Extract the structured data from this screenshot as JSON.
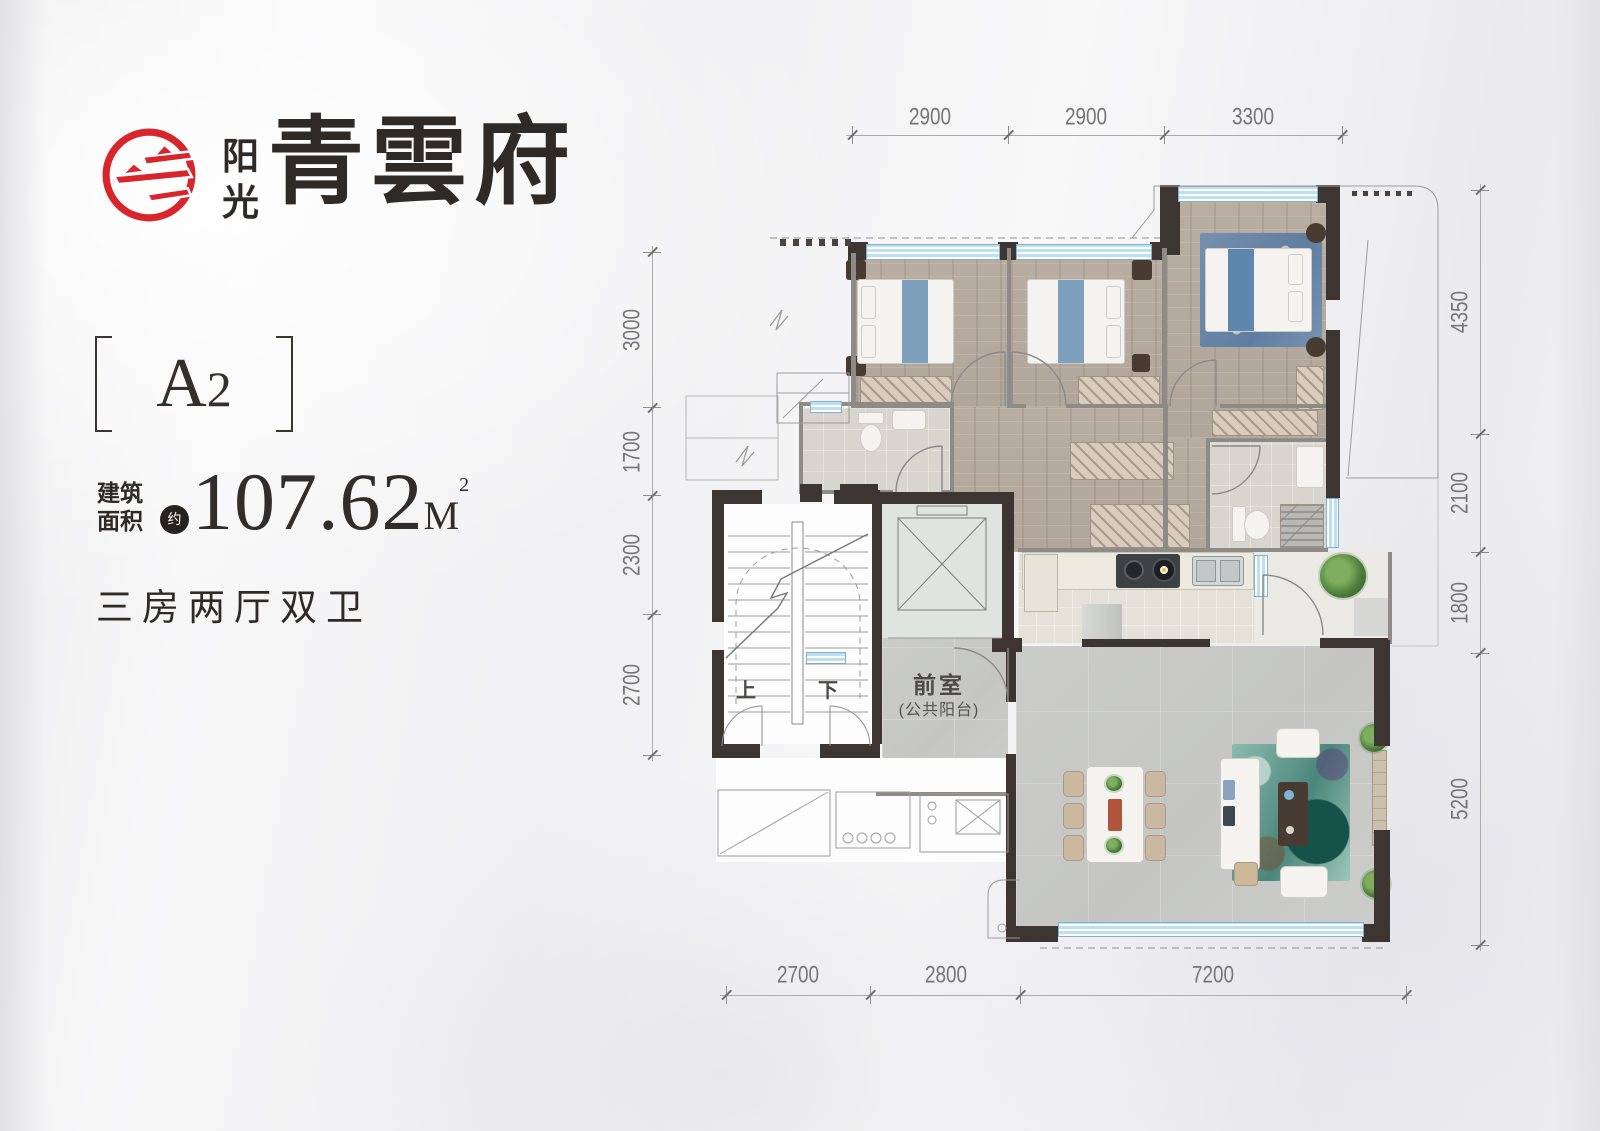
{
  "brand": {
    "logo_icon": "sun-swoosh-ring-icon",
    "name_small_top": "阳",
    "name_small_bottom": "光",
    "name_large": "青雲府"
  },
  "unit": {
    "code_letter": "A",
    "code_number": "2",
    "area_label_line1": "建筑",
    "area_label_line2": "面积",
    "area_approx_badge": "约",
    "area_value": "107.62",
    "area_unit": "M",
    "area_superscript": "2",
    "layout_description": "三房两厅双卫"
  },
  "plan": {
    "labels": {
      "front_room": "前室",
      "front_room_sub": "(公共阳台)",
      "stairs_up": "上",
      "stairs_down": "下"
    },
    "dimensions": {
      "top": [
        "2900",
        "2900",
        "3300"
      ],
      "left": [
        "3000",
        "1700",
        "2300",
        "2700"
      ],
      "right": [
        "4350",
        "2100",
        "1800",
        "5200"
      ],
      "bottom": [
        "2700",
        "2800",
        "7200"
      ]
    }
  },
  "colors": {
    "brand_red": "#d8252c",
    "text_ink": "#2f2b28",
    "wall_dark": "#3c3531",
    "window_blue": "#bcdff2",
    "floor_wood": "#b5aa9e",
    "floor_tile": "#c9cac8",
    "rug_teal": "#4f8d82",
    "rug_master_blue": "#6f8cab"
  }
}
